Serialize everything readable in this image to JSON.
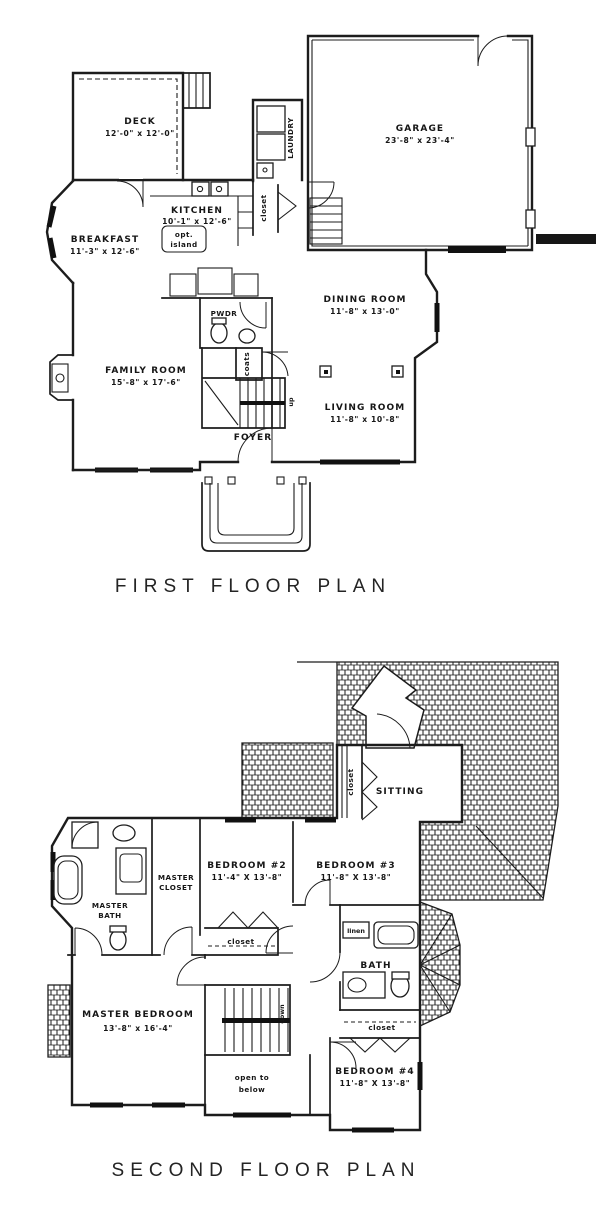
{
  "document": {
    "kind": "architectural floor plan drawing",
    "ink_color": "#1c1c1c",
    "paper_color": "#ffffff"
  },
  "first_floor": {
    "title": "FIRST FLOOR PLAN",
    "deck_name": "DECK",
    "deck_dims": "12'-0\" x 12'-0\"",
    "garage_name": "GARAGE",
    "garage_dims": "23'-8\" x 23'-4\"",
    "laundry": "LAUNDRY",
    "hall_closet": "closet",
    "kitchen_name": "KITCHEN",
    "kitchen_dims": "10'-1\" x 12'-6\"",
    "island_line1": "opt.",
    "island_line2": "island",
    "breakfast_name": "BREAKFAST",
    "breakfast_dims": "11'-3\" x 12'-6\"",
    "dining_name": "DINING ROOM",
    "dining_dims": "11'-8\" x 13'-0\"",
    "pwdr": "PWDR",
    "coats": "coats",
    "family_name": "FAMILY ROOM",
    "family_dims": "15'-8\" x 17'-6\"",
    "living_name": "LIVING ROOM",
    "living_dims": "11'-8\" x 10'-8\"",
    "foyer": "FOYER",
    "up": "up"
  },
  "second_floor": {
    "title": "SECOND FLOOR PLAN",
    "sitting": "SITTING",
    "sitting_closet": "closet",
    "bedroom2_name": "BEDROOM #2",
    "bedroom2_dims": "11'-4\" X 13'-8\"",
    "bedroom3_name": "BEDROOM #3",
    "bedroom3_dims": "11'-8\" X 13'-8\"",
    "master_closet_line1": "MASTER",
    "master_closet_line2": "CLOSET",
    "master_bath_line1": "MASTER",
    "master_bath_line2": "BATH",
    "master_bedroom_name": "MASTER BEDROOM",
    "master_bedroom_dims": "13'-8\" x 16'-4\"",
    "bedroom2_closet": "closet",
    "linen": "linen",
    "bath": "BATH",
    "down": "down",
    "open_below_line1": "open to",
    "open_below_line2": "below",
    "bath_closet": "closet",
    "bedroom4_name": "BEDROOM #4",
    "bedroom4_dims": "11'-8\" X 13'-8\""
  }
}
